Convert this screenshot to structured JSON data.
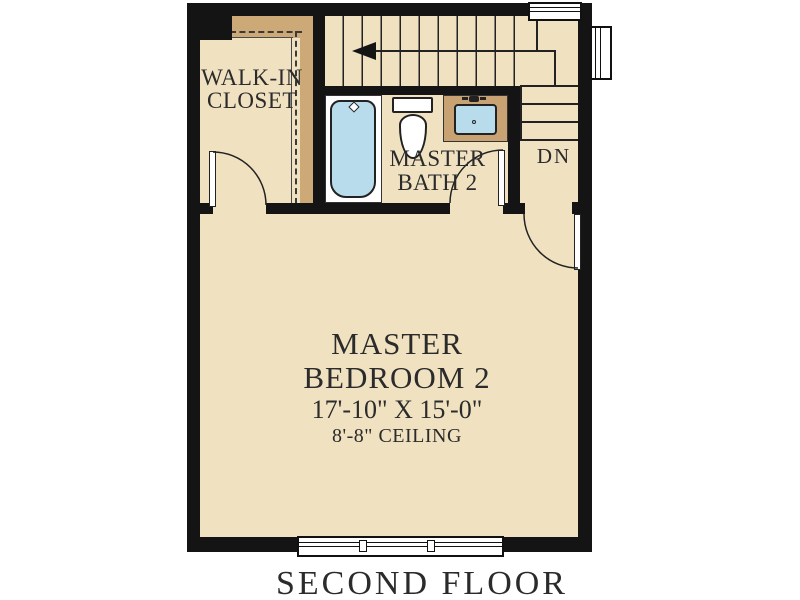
{
  "page": {
    "title": "SECOND FLOOR"
  },
  "rooms": {
    "closet": {
      "name_line1": "WALK-IN",
      "name_line2": "CLOSET"
    },
    "bath": {
      "name_line1": "MASTER",
      "name_line2": "BATH 2"
    },
    "bedroom": {
      "name_line1": "MASTER",
      "name_line2": "BEDROOM 2",
      "dimensions": "17'-10\" X 15'-0\"",
      "ceiling": "8'-8\" CEILING"
    },
    "stairs": {
      "direction_label": "DN"
    }
  },
  "fixtures": [
    {
      "name": "bathtub"
    },
    {
      "name": "toilet"
    },
    {
      "name": "vanity-sink"
    }
  ],
  "windows": [
    {
      "name": "top-window"
    },
    {
      "name": "right-window"
    },
    {
      "name": "bottom-window"
    }
  ],
  "colors": {
    "floor": "#f0e2c1",
    "accent_band": "#cda978",
    "counter": "#c8a273",
    "fixture_blue": "#b9dcec",
    "wall": "#141414"
  }
}
